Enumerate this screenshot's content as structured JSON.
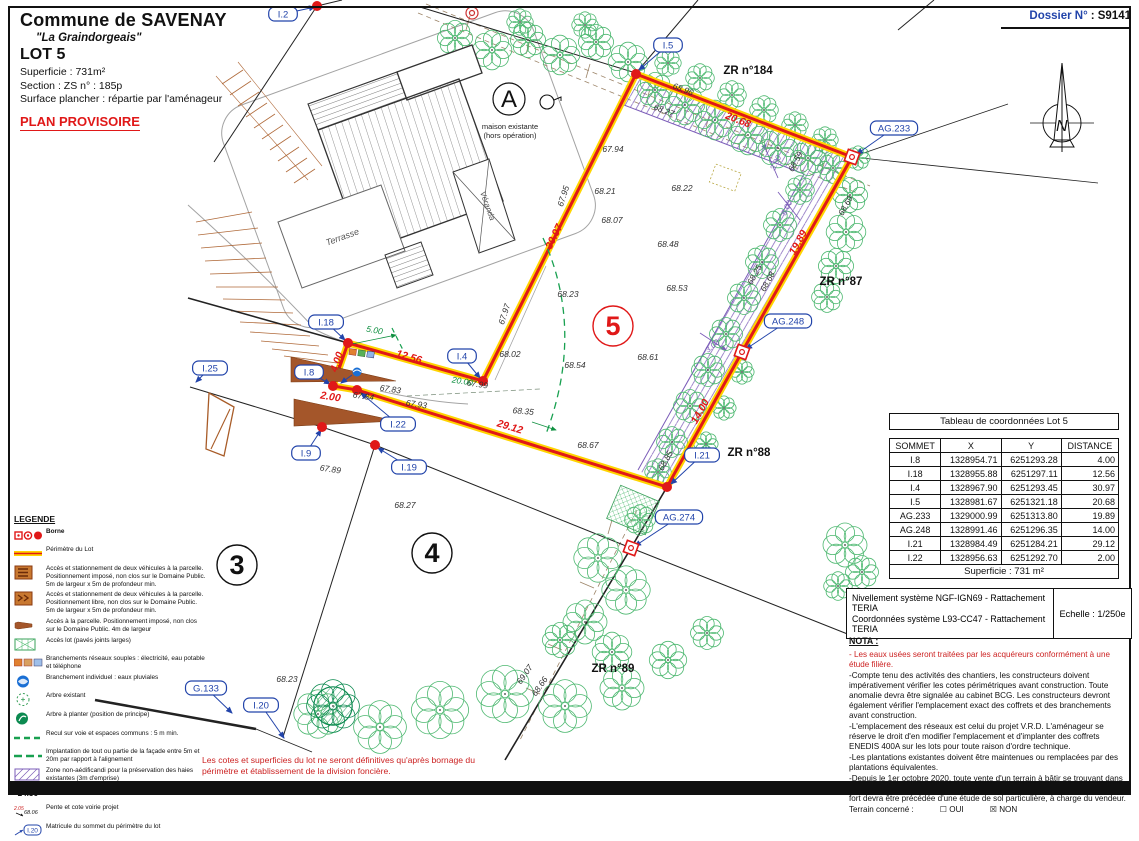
{
  "header": {
    "commune": "Commune de SAVENAY",
    "place": "\"La Graindorgeais\"",
    "lot_title": "LOT 5",
    "superficie": "Superficie :  731m²",
    "section": "Section :  ZS     n° :  185p",
    "surface_plancher": "Surface plancher : répartie par l'aménageur",
    "plan_status": "PLAN PROVISOIRE"
  },
  "dossier": {
    "label": "Dossier N°",
    "value": ": S9141"
  },
  "table": {
    "title": "Tableau de coordonnées Lot 5",
    "headers": [
      "SOMMET",
      "X",
      "Y",
      "DISTANCE"
    ],
    "rows": [
      [
        "I.8",
        "1328954.71",
        "6251293.28",
        "4.00"
      ],
      [
        "I.18",
        "1328955.88",
        "6251297.11",
        "12.56"
      ],
      [
        "I.4",
        "1328967.90",
        "6251293.45",
        "30.97"
      ],
      [
        "I.5",
        "1328981.67",
        "6251321.18",
        "20.68"
      ],
      [
        "AG.233",
        "1329000.99",
        "6251313.80",
        "19.89"
      ],
      [
        "AG.248",
        "1328991.46",
        "6251296.35",
        "14.00"
      ],
      [
        "I.21",
        "1328984.49",
        "6251284.21",
        "29.12"
      ],
      [
        "I.22",
        "1328956.63",
        "6251292.70",
        "2.00"
      ]
    ],
    "footer": "Superficie : 731 m²"
  },
  "survey": {
    "line1": "Nivellement système NGF-IGN69 - Rattachement TERIA",
    "line2": "Coordonnées système L93-CC47  - Rattachement TERIA",
    "scale": "Echelle : 1/250e"
  },
  "nota": {
    "title": "NOTA :",
    "red_item": "- Les eaux usées seront traitées par les acquéreurs conformément à une étude filière.",
    "items": [
      "-Compte tenu des activités des chantiers, les constructeurs doivent impérativement vérifier les cotes périmétriques avant construction. Toute anomalie devra être signalée au cabinet BCG. Les constructeurs devront également vérifier l'emplacement exact des coffrets et des branchements avant construction.",
      "-L'emplacement des réseaux est celui du projet V.R.D. L'aménageur se réserve le droit d'en modifier l'emplacement et d'implanter des coffrets ENEDIS 400A sur les lots pour toute raison d'ordre technique.",
      "-Les plantations existantes doivent être maintenues ou remplacées par des plantations équivalentes.",
      "-Depuis le 1er octobre 2020, toute vente d'un terrain à bâtir se trouvant dans une zone à risque de retrait-gonflement d'argiles considérée en aléa moyen à fort devra être précédée d'une étude de sol particulière, à charge du vendeur."
    ],
    "terrain_label": "Terrain concerné :",
    "oui": "☐ OUI",
    "non": "☒ NON"
  },
  "legend": {
    "title": "LEGENDE",
    "items": [
      {
        "icon": "borne-set",
        "text": "Borne",
        "bold": true
      },
      {
        "icon": "perimeter",
        "text": "Périmètre du Lot"
      },
      {
        "icon": "access-imposed",
        "text": "Accès et stationnement de deux véhicules à la parcelle. Positionnement imposé, non clos sur le Domaine Public. 5m de largeur x 5m de profondeur min."
      },
      {
        "icon": "access-free",
        "text": "Accès et stationnement de deux véhicules à la parcelle. Positionnement libre, non clos sur le Domaine Public. 5m de largeur x 5m de profondeur min."
      },
      {
        "icon": "access-arrow",
        "text": "Accès à la parcelle. Positionnement imposé, non clos sur le Domaine Public. 4m de largeur"
      },
      {
        "icon": "paved",
        "text": "Accès lot (pavés joints larges)"
      },
      {
        "icon": "networks",
        "text": "Branchements réseaux souples : électricité, eau potable et téléphone"
      },
      {
        "icon": "rainwater",
        "text": "Branchement individuel : eaux pluviales"
      },
      {
        "icon": "tree-existing",
        "text": "Arbre existant"
      },
      {
        "icon": "tree-planted",
        "text": "Arbre à planter (position de principe)"
      },
      {
        "icon": "setback",
        "text": "Recul sur voie et espaces communs : 5 m min."
      },
      {
        "icon": "facade",
        "text": "Implantation de tout ou partie de la façade entre 5m et 20m par rapport à l'alignement"
      },
      {
        "icon": "non-aedificandi",
        "text": "Zone non-aédificandi pour la préservation des haies existantes (3m d'emprise)"
      },
      {
        "icon": "elevation",
        "sample": "24.56",
        "text": "Cote altimétrique du terrain naturel"
      },
      {
        "icon": "slope",
        "sample": "2.05",
        "sample2": "68.06",
        "text": "Pente et cote voirie projet"
      },
      {
        "icon": "vertex-id",
        "sample": "I.20",
        "text": "Matricule du sommet du périmètre du lot"
      }
    ]
  },
  "footnote": {
    "text": "Les cotes et superficies du lot ne seront définitives qu'après bornage du périmètre et établissement de la division foncière."
  },
  "colors": {
    "perimeter_red": "#e01818",
    "perimeter_yellow": "#ffd400",
    "vertex_blue": "#2244aa",
    "tree_green": "#4db870",
    "zone_purple": "#7b5cb8",
    "access_brown": "#a4562a",
    "note_red": "#cc2222"
  },
  "plan": {
    "building": {
      "label_a": "A",
      "note1": "maison existante",
      "note2": "(hors opération)",
      "terrasse": "Terrasse",
      "veranda": "Véranda"
    },
    "vertex_labels": [
      {
        "id": "I.2",
        "x": 283,
        "y": 14,
        "tx": 315,
        "ty": 7
      },
      {
        "id": "I.5",
        "x": 668,
        "y": 45,
        "tx": 639,
        "ty": 70
      },
      {
        "id": "I.18",
        "x": 326,
        "y": 322,
        "tx": 345,
        "ty": 340
      },
      {
        "id": "I.8",
        "x": 309,
        "y": 372,
        "tx": 330,
        "ty": 384
      },
      {
        "id": "I.4",
        "x": 462,
        "y": 356,
        "tx": 480,
        "ty": 378
      },
      {
        "id": "I.22",
        "x": 398,
        "y": 424,
        "tx": 361,
        "ty": 393
      },
      {
        "id": "I.9",
        "x": 306,
        "y": 453,
        "tx": 321,
        "ty": 430
      },
      {
        "id": "I.19",
        "x": 409,
        "y": 467,
        "tx": 378,
        "ty": 448
      },
      {
        "id": "I.21",
        "x": 702,
        "y": 455,
        "tx": 671,
        "ty": 484
      },
      {
        "id": "I.25",
        "x": 210,
        "y": 368,
        "tx": 196,
        "ty": 382
      },
      {
        "id": "I.20",
        "x": 261,
        "y": 705,
        "tx": 284,
        "ty": 738
      },
      {
        "id": "G.133",
        "x": 206,
        "y": 688,
        "tx": 232,
        "ty": 713
      },
      {
        "id": "AG.233",
        "x": 894,
        "y": 128,
        "tx": 857,
        "ty": 154
      },
      {
        "id": "AG.248",
        "x": 788,
        "y": 321,
        "tx": 746,
        "ty": 349
      },
      {
        "id": "AG.274",
        "x": 679,
        "y": 517,
        "tx": 635,
        "ty": 546
      }
    ],
    "bornes": [
      {
        "type": "dot",
        "x": 317,
        "y": 6
      },
      {
        "type": "dot",
        "x": 636,
        "y": 74
      },
      {
        "type": "dot",
        "x": 348,
        "y": 343
      },
      {
        "type": "dot",
        "x": 333,
        "y": 386
      },
      {
        "type": "dot",
        "x": 357,
        "y": 390
      },
      {
        "type": "dot",
        "x": 483,
        "y": 381
      },
      {
        "type": "dot",
        "x": 322,
        "y": 427
      },
      {
        "type": "dot",
        "x": 375,
        "y": 445
      },
      {
        "type": "dot",
        "x": 667,
        "y": 487
      },
      {
        "type": "square",
        "x": 852,
        "y": 157
      },
      {
        "type": "square",
        "x": 742,
        "y": 352
      },
      {
        "type": "square",
        "x": 631,
        "y": 548
      },
      {
        "type": "double-circle",
        "x": 472,
        "y": 13
      }
    ],
    "distances": [
      {
        "v": "4.00",
        "x": 340,
        "y": 363,
        "rot": -71
      },
      {
        "v": "2.00",
        "x": 330,
        "y": 400,
        "rot": 9
      },
      {
        "v": "12.56",
        "x": 408,
        "y": 360,
        "rot": 16
      },
      {
        "v": "30.97",
        "x": 557,
        "y": 238,
        "rot": -64
      },
      {
        "v": "20.68",
        "x": 737,
        "y": 123,
        "rot": 21
      },
      {
        "v": "19.89",
        "x": 801,
        "y": 244,
        "rot": -61
      },
      {
        "v": "14.00",
        "x": 703,
        "y": 413,
        "rot": -61
      },
      {
        "v": "29.12",
        "x": 509,
        "y": 430,
        "rot": 17
      }
    ],
    "green_dims": [
      {
        "v": "5.00",
        "x": 374,
        "y": 333,
        "rot": 10
      },
      {
        "v": "20.00",
        "x": 462,
        "y": 384,
        "rot": 9
      }
    ],
    "purple_dims": [
      {
        "v": "3.00",
        "x": 778,
        "y": 164,
        "rot": -64
      },
      {
        "v": "5.00",
        "x": 789,
        "y": 209,
        "rot": -64
      },
      {
        "v": "3.00",
        "x": 714,
        "y": 348,
        "rot": -40
      }
    ],
    "elevations": [
      {
        "v": "67.94",
        "x": 613,
        "y": 152,
        "rot": 0
      },
      {
        "v": "68.21",
        "x": 605,
        "y": 194,
        "rot": 0
      },
      {
        "v": "68.22",
        "x": 682,
        "y": 191,
        "rot": 0
      },
      {
        "v": "68.07",
        "x": 612,
        "y": 223,
        "rot": 0
      },
      {
        "v": "68.48",
        "x": 668,
        "y": 247,
        "rot": 0
      },
      {
        "v": "68.53",
        "x": 677,
        "y": 291,
        "rot": 0
      },
      {
        "v": "68.23",
        "x": 568,
        "y": 297,
        "rot": 0
      },
      {
        "v": "68.54",
        "x": 575,
        "y": 368,
        "rot": 0
      },
      {
        "v": "68.61",
        "x": 648,
        "y": 360,
        "rot": 0
      },
      {
        "v": "68.35",
        "x": 523,
        "y": 414,
        "rot": 5
      },
      {
        "v": "68.67",
        "x": 588,
        "y": 448,
        "rot": 0
      },
      {
        "v": "68.02",
        "x": 510,
        "y": 357,
        "rot": 0
      },
      {
        "v": "67.99",
        "x": 477,
        "y": 387,
        "rot": 8
      },
      {
        "v": "67.93",
        "x": 416,
        "y": 407,
        "rot": 8
      },
      {
        "v": "67.84",
        "x": 363,
        "y": 399,
        "rot": 8
      },
      {
        "v": "67.83",
        "x": 390,
        "y": 392,
        "rot": 8
      },
      {
        "v": "67.97",
        "x": 507,
        "y": 315,
        "rot": -72
      },
      {
        "v": "67.95",
        "x": 566,
        "y": 197,
        "rot": -72
      },
      {
        "v": "67.89",
        "x": 330,
        "y": 472,
        "rot": 8
      },
      {
        "v": "68.27",
        "x": 405,
        "y": 508,
        "rot": 0
      },
      {
        "v": "68.23",
        "x": 287,
        "y": 682,
        "rot": 0
      },
      {
        "v": "68.96",
        "x": 682,
        "y": 92,
        "rot": 21
      },
      {
        "v": "68.27",
        "x": 663,
        "y": 113,
        "rot": 21
      },
      {
        "v": "68.59",
        "x": 798,
        "y": 163,
        "rot": -61
      },
      {
        "v": "68.69",
        "x": 848,
        "y": 207,
        "rot": -61
      },
      {
        "v": "68.25",
        "x": 757,
        "y": 276,
        "rot": -61
      },
      {
        "v": "68.68",
        "x": 770,
        "y": 283,
        "rot": -61
      },
      {
        "v": "68.85",
        "x": 668,
        "y": 462,
        "rot": -61
      },
      {
        "v": "69.07",
        "x": 527,
        "y": 676,
        "rot": -55
      },
      {
        "v": "68.66",
        "x": 542,
        "y": 688,
        "rot": -55
      }
    ],
    "parcels": [
      {
        "name": "ZR n°184",
        "x": 748,
        "y": 74
      },
      {
        "name": "ZR n°87",
        "x": 841,
        "y": 285
      },
      {
        "name": "ZR n°88",
        "x": 749,
        "y": 456
      },
      {
        "name": "ZR n°89",
        "x": 613,
        "y": 672
      }
    ],
    "lots": [
      {
        "n": "3",
        "x": 237,
        "y": 565,
        "color": "#111111"
      },
      {
        "n": "4",
        "x": 432,
        "y": 553,
        "color": "#111111"
      },
      {
        "n": "5",
        "x": 613,
        "y": 326,
        "color": "#e01818"
      }
    ],
    "trees": [
      [
        455,
        38,
        16
      ],
      [
        492,
        50,
        18
      ],
      [
        528,
        40,
        16
      ],
      [
        560,
        55,
        18
      ],
      [
        596,
        42,
        16
      ],
      [
        628,
        62,
        18
      ],
      [
        585,
        25,
        12
      ],
      [
        520,
        22,
        12
      ],
      [
        655,
        90,
        16
      ],
      [
        685,
        105,
        18
      ],
      [
        715,
        120,
        18
      ],
      [
        748,
        135,
        18
      ],
      [
        778,
        148,
        18
      ],
      [
        808,
        158,
        16
      ],
      [
        833,
        168,
        14
      ],
      [
        668,
        63,
        12
      ],
      [
        700,
        78,
        13
      ],
      [
        732,
        95,
        13
      ],
      [
        764,
        110,
        13
      ],
      [
        795,
        125,
        12
      ],
      [
        825,
        140,
        12
      ],
      [
        850,
        195,
        16
      ],
      [
        846,
        232,
        18
      ],
      [
        836,
        266,
        16
      ],
      [
        827,
        297,
        14
      ],
      [
        858,
        158,
        11
      ],
      [
        800,
        190,
        13
      ],
      [
        780,
        225,
        15
      ],
      [
        762,
        262,
        15
      ],
      [
        744,
        298,
        15
      ],
      [
        726,
        334,
        15
      ],
      [
        708,
        370,
        15
      ],
      [
        690,
        406,
        15
      ],
      [
        672,
        442,
        14
      ],
      [
        658,
        472,
        12
      ],
      [
        742,
        372,
        11
      ],
      [
        724,
        408,
        11
      ],
      [
        706,
        444,
        11
      ],
      [
        640,
        520,
        14
      ],
      [
        598,
        558,
        22
      ],
      [
        626,
        590,
        22
      ],
      [
        585,
        622,
        20
      ],
      [
        612,
        652,
        18
      ],
      [
        560,
        640,
        16
      ],
      [
        318,
        714,
        22
      ],
      [
        380,
        727,
        24
      ],
      [
        440,
        710,
        26
      ],
      [
        505,
        694,
        26
      ],
      [
        565,
        706,
        24
      ],
      [
        622,
        688,
        20
      ],
      [
        668,
        660,
        17
      ],
      [
        707,
        633,
        15
      ],
      [
        845,
        545,
        20
      ],
      [
        862,
        572,
        15
      ],
      [
        838,
        586,
        13
      ]
    ],
    "planted_tree": [
      333,
      706,
      24
    ]
  }
}
